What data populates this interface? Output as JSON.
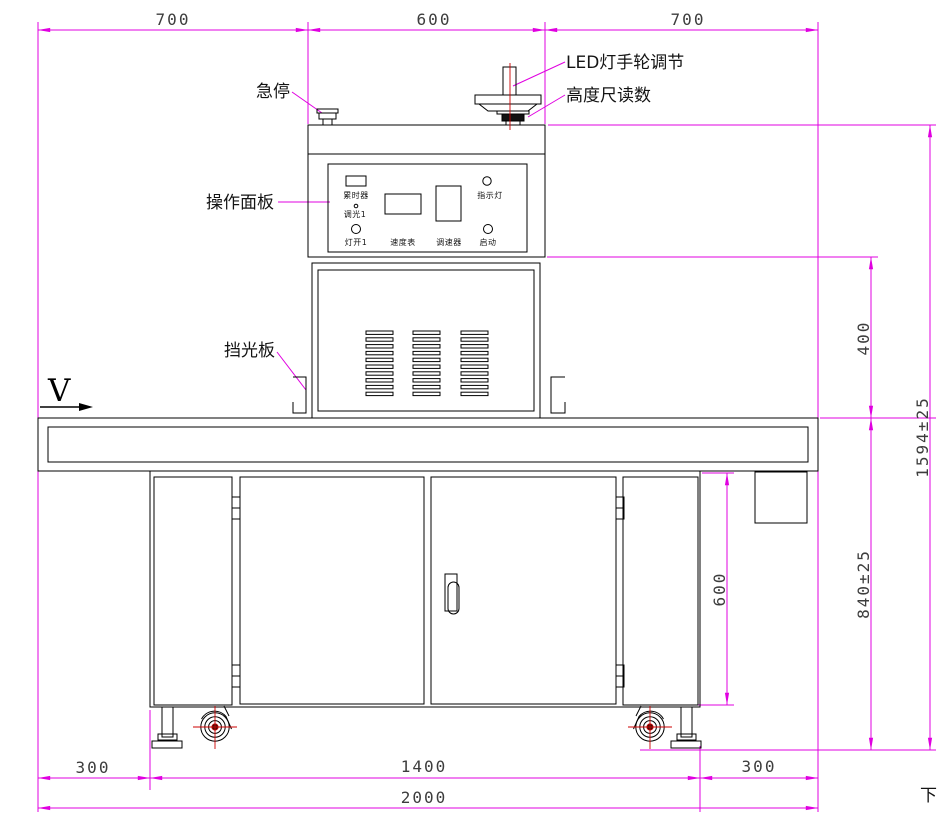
{
  "labels": {
    "emergency_stop": "急停",
    "operation_panel": "操作面板",
    "light_shield": "挡光板",
    "led_handwheel": "LED灯手轮调节",
    "height_gauge": "高度尺读数",
    "direction": "V",
    "page_marker": "下"
  },
  "panel": {
    "timer": "累时器",
    "dimmer1": "调光1",
    "lamp_on1": "灯开1",
    "speed_meter": "速度表",
    "speed_controller": "调速器",
    "indicator_lamp": "指示灯",
    "start": "启动"
  },
  "dimensions": {
    "top_left": "700",
    "top_middle": "600",
    "top_right": "700",
    "lamp_height": "400",
    "total_height": "1594±25",
    "table_height": "840±25",
    "cabinet_height": "600",
    "bottom_left": "300",
    "bottom_middle": "1400",
    "bottom_right": "300",
    "bottom_total": "2000"
  },
  "colors": {
    "dimension_line": "#e000e0",
    "outline": "#000000",
    "center_line": "#cc0000",
    "dimension_text": "#3d3d3d"
  }
}
